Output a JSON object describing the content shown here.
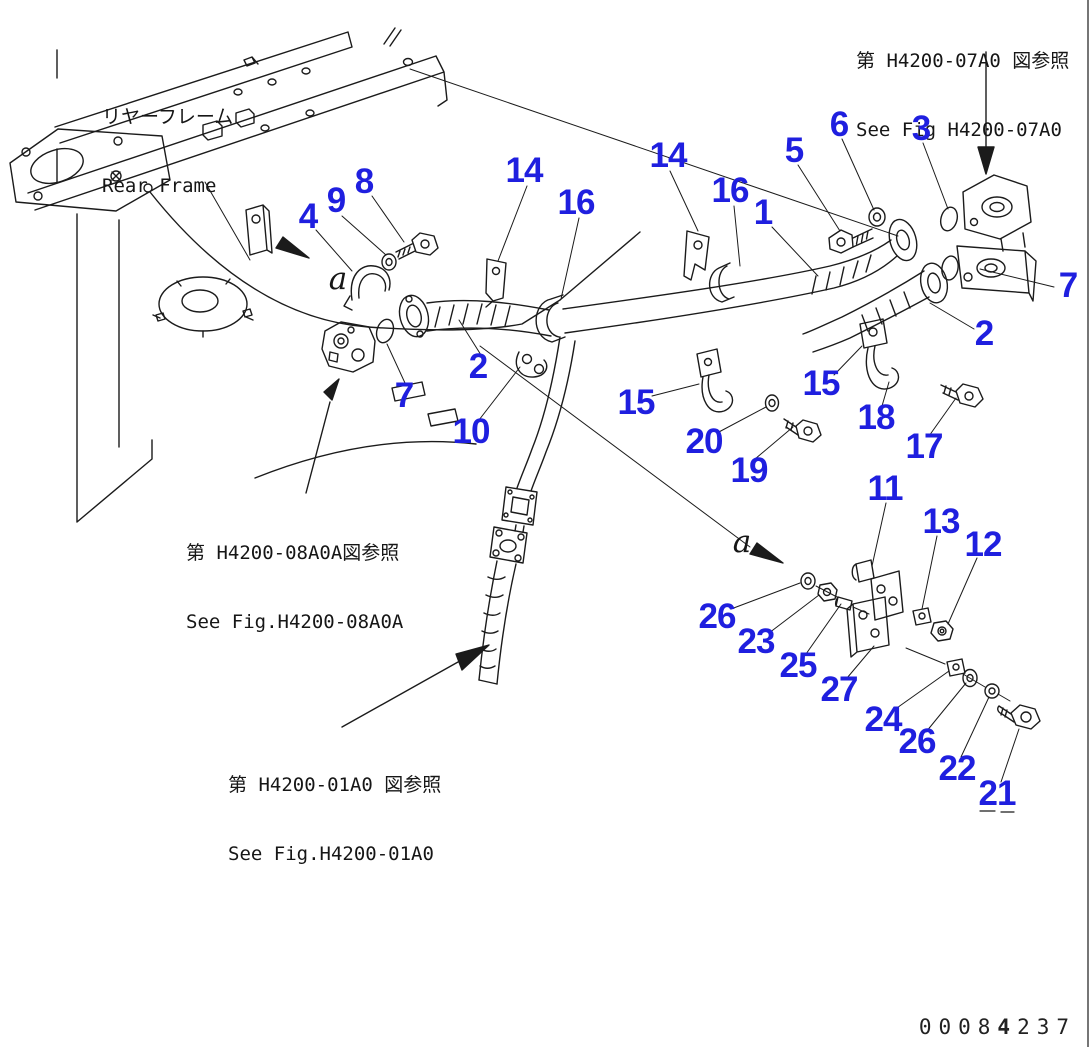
{
  "colors": {
    "callout": "#1f1fdf",
    "line": "#1b1b1b",
    "background": "#ffffff"
  },
  "frame_label": {
    "jp": "リヤーフレーム",
    "en": "Rear Frame"
  },
  "references": [
    {
      "id": "fig-h4200-07a0",
      "jp": "第 H4200-07A0 図参照",
      "en": "See Fig H4200-07A0"
    },
    {
      "id": "fig-h4200-08a0a",
      "jp": "第 H4200-08A0A図参照",
      "en": "See Fig.H4200-08A0A"
    },
    {
      "id": "fig-h4200-01a0",
      "jp": "第 H4200-01A0 図参照",
      "en": "See Fig.H4200-01A0"
    }
  ],
  "view_letter": "a",
  "view_letters": [
    {
      "x": 338,
      "y": 279
    },
    {
      "x": 742,
      "y": 542
    }
  ],
  "doc_number": {
    "prefix": "0008",
    "bold": "4",
    "suffix": "237"
  },
  "callouts": [
    {
      "n": "8",
      "x": 364,
      "y": 182
    },
    {
      "n": "9",
      "x": 336,
      "y": 201
    },
    {
      "n": "4",
      "x": 308,
      "y": 217
    },
    {
      "n": "14",
      "x": 524,
      "y": 171
    },
    {
      "n": "16",
      "x": 576,
      "y": 203
    },
    {
      "n": "14",
      "x": 668,
      "y": 156
    },
    {
      "n": "16",
      "x": 730,
      "y": 191
    },
    {
      "n": "1",
      "x": 763,
      "y": 213
    },
    {
      "n": "5",
      "x": 794,
      "y": 151
    },
    {
      "n": "6",
      "x": 839,
      "y": 125
    },
    {
      "n": "3",
      "x": 921,
      "y": 129
    },
    {
      "n": "7",
      "x": 1068,
      "y": 286
    },
    {
      "n": "2",
      "x": 984,
      "y": 334
    },
    {
      "n": "2",
      "x": 478,
      "y": 367
    },
    {
      "n": "7",
      "x": 404,
      "y": 396
    },
    {
      "n": "10",
      "x": 471,
      "y": 432
    },
    {
      "n": "15",
      "x": 636,
      "y": 403
    },
    {
      "n": "20",
      "x": 704,
      "y": 442
    },
    {
      "n": "19",
      "x": 749,
      "y": 471
    },
    {
      "n": "15",
      "x": 821,
      "y": 384
    },
    {
      "n": "18",
      "x": 876,
      "y": 418
    },
    {
      "n": "17",
      "x": 924,
      "y": 447
    },
    {
      "n": "11",
      "x": 885,
      "y": 489
    },
    {
      "n": "13",
      "x": 941,
      "y": 522
    },
    {
      "n": "12",
      "x": 983,
      "y": 545
    },
    {
      "n": "26",
      "x": 717,
      "y": 617
    },
    {
      "n": "23",
      "x": 756,
      "y": 642
    },
    {
      "n": "25",
      "x": 798,
      "y": 666
    },
    {
      "n": "27",
      "x": 839,
      "y": 690
    },
    {
      "n": "24",
      "x": 883,
      "y": 720
    },
    {
      "n": "26",
      "x": 917,
      "y": 742
    },
    {
      "n": "22",
      "x": 957,
      "y": 769
    },
    {
      "n": "21",
      "x": 997,
      "y": 794
    }
  ]
}
